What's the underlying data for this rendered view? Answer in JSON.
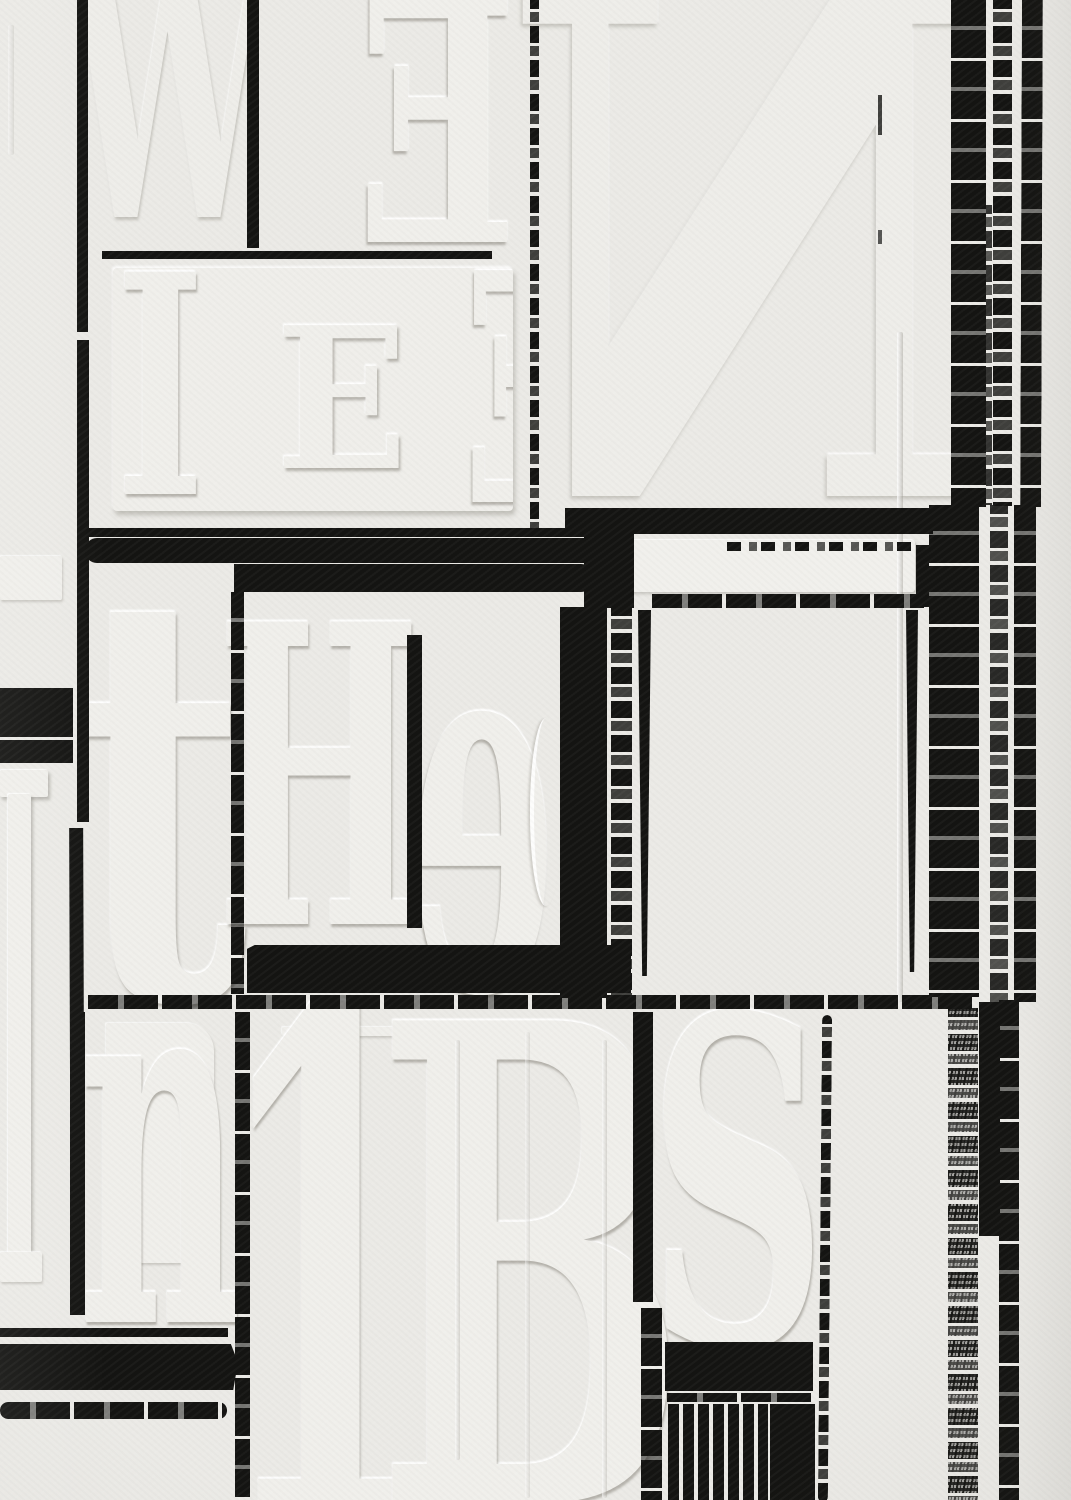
{
  "artwork": {
    "kind": "blind-embossed letterpress print with black ink rules",
    "colors": {
      "paper": "#ebeae6",
      "paperBright": "#f0efeb",
      "ink": "#141412",
      "embossShadow": "#7d7a70"
    },
    "letters": {
      "top": [
        {
          "glyph": "W",
          "mirrored": false
        },
        {
          "glyph": "E",
          "mirrored": true
        },
        {
          "glyph": "N",
          "mirrored": true
        }
      ],
      "row2": [
        {
          "glyph": "I",
          "mirrored": false
        },
        {
          "glyph": "E",
          "mirrored": false
        },
        {
          "glyph": "E",
          "mirrored": true
        }
      ],
      "middle": [
        {
          "glyph": "t",
          "mirrored": false
        },
        {
          "glyph": "H",
          "mirrored": false
        },
        {
          "glyph": "e",
          "mirrored": true
        }
      ],
      "bottom": [
        {
          "glyph": "n",
          "mirrored": false
        },
        {
          "glyph": "1",
          "mirrored": false
        },
        {
          "glyph": "B",
          "mirrored": false
        },
        {
          "glyph": "S",
          "mirrored": false
        }
      ]
    }
  }
}
